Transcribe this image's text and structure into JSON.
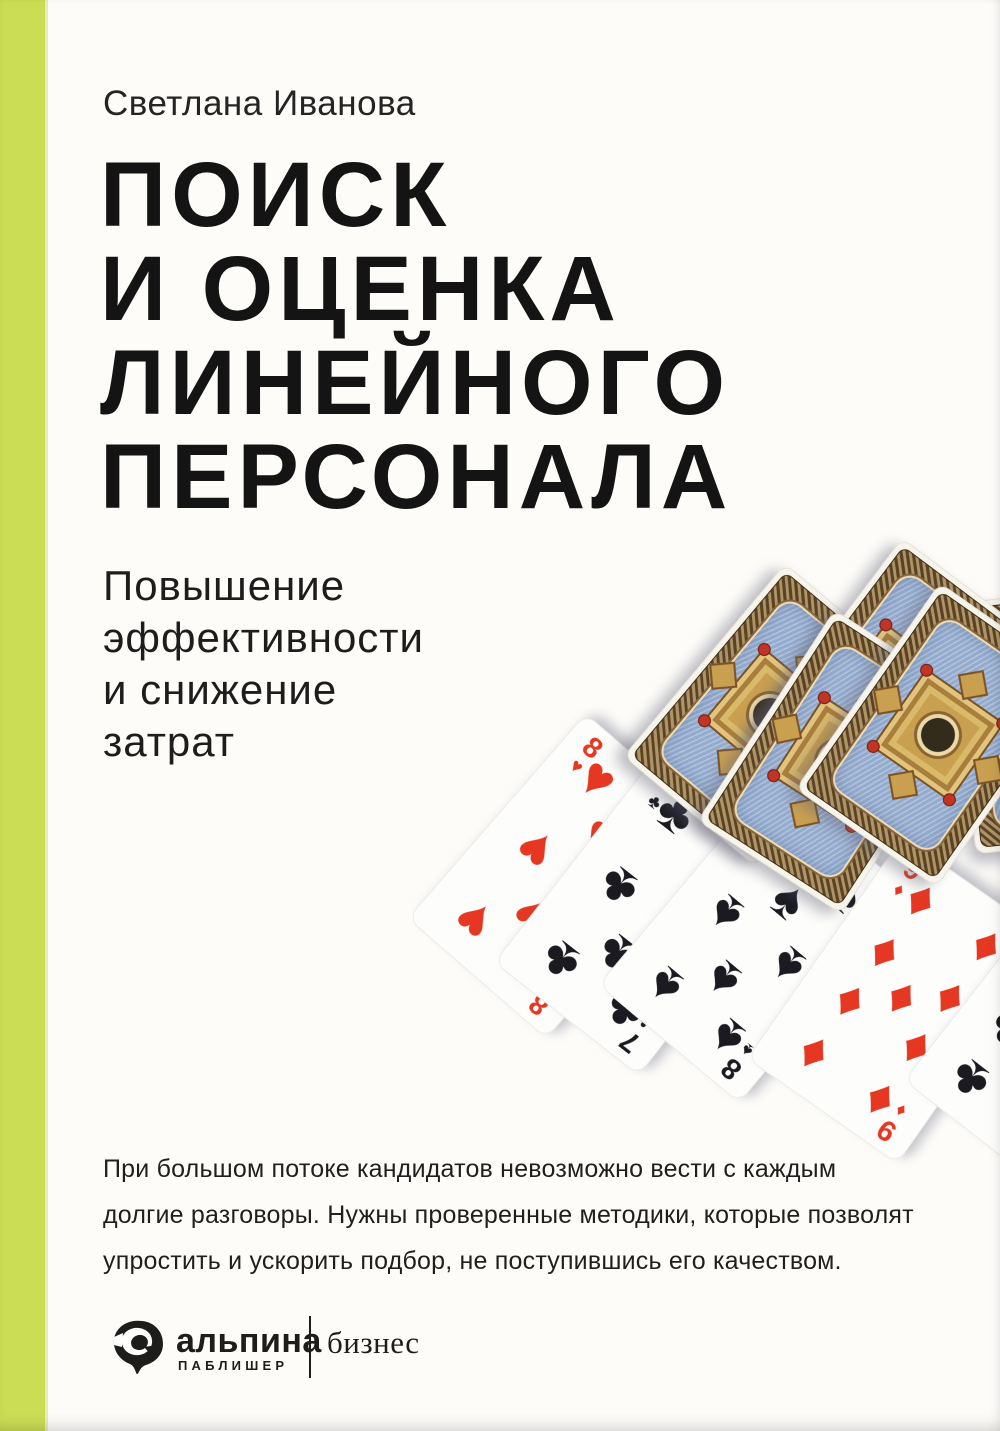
{
  "cover": {
    "author": "Светлана Иванова",
    "title_lines": [
      "ПОИСК",
      "И ОЦЕНКА",
      "ЛИНЕЙНОГО",
      "ПЕРСОНАЛА"
    ],
    "subtitle_lines": [
      "Повышение",
      "эффективности",
      "и снижение",
      "затрат"
    ],
    "blurb_lines": [
      "При большом потоке кандидатов невозможно вести с каждым",
      "долгие разговоры. Нужны проверенные методики, которые позволят",
      "упростить и ускорить подбор, не поступившись его качеством."
    ],
    "publisher_logo": {
      "name": "альпина",
      "sub": "ПАБЛИШЕР",
      "series": "бизнес"
    },
    "colors": {
      "stripe": "#cbdd55",
      "stripe_edge": "#e7edb4",
      "red": "#e53722",
      "black": "#1a1a20",
      "paper": "#fdfcf9",
      "ink": "#141414"
    }
  },
  "cards": {
    "face_up": [
      {
        "rank": "8",
        "suit": "♥",
        "suit_name": "hearts",
        "color": "red",
        "pips": 8
      },
      {
        "rank": "7",
        "suit": "♣",
        "suit_name": "clubs",
        "color": "black",
        "pips": 7
      },
      {
        "rank": "8",
        "suit": "♠",
        "suit_name": "spades",
        "color": "black",
        "pips": 8
      },
      {
        "rank": "9",
        "suit": "♦",
        "suit_name": "diamonds",
        "color": "red",
        "pips": 9
      },
      {
        "rank": "",
        "suit": "♣",
        "suit_name": "clubs",
        "color": "black",
        "pips": 9
      }
    ],
    "face_down_count": 5
  }
}
